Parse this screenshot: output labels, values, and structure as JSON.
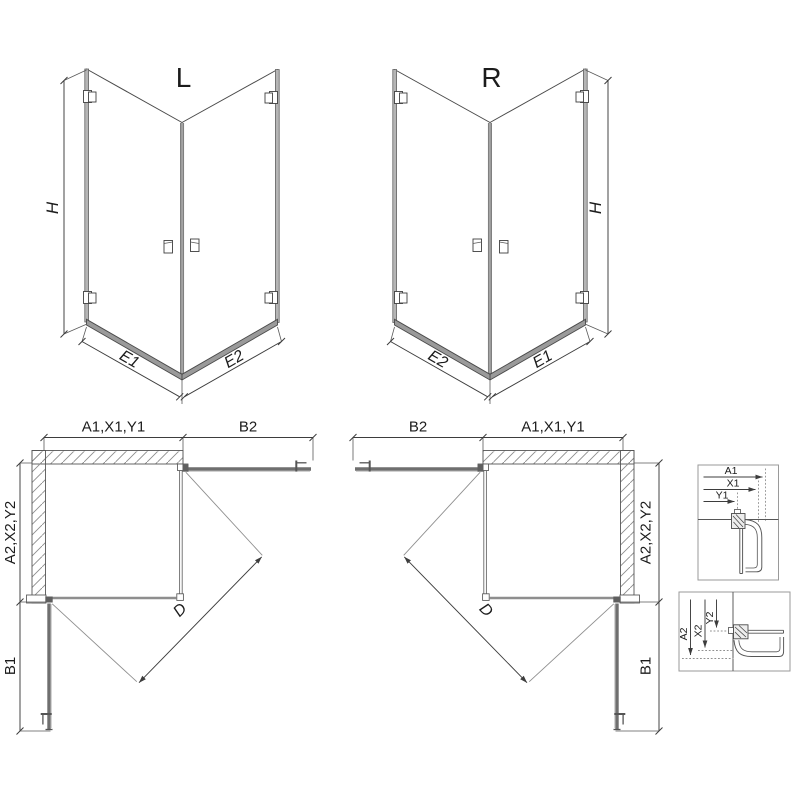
{
  "iso_left": {
    "label": "L",
    "dim_h": "H",
    "dim_left": "E1",
    "dim_right": "E2"
  },
  "iso_right": {
    "label": "R",
    "dim_h": "H",
    "dim_left": "E2",
    "dim_right": "E1"
  },
  "plan_left": {
    "dim_top_left": "A1,X1,Y1",
    "dim_top_right": "B2",
    "dim_side_top": "A2,X2,Y2",
    "dim_side_bottom": "B1",
    "dim_diag": "D"
  },
  "plan_right": {
    "dim_top_left": "B2",
    "dim_top_right": "A1,X1,Y1",
    "dim_side_top": "A2,X2,Y2",
    "dim_side_bottom": "B1",
    "dim_diag": "D"
  },
  "detail_top": {
    "dim_a": "A1",
    "dim_x": "X1",
    "dim_y": "Y1"
  },
  "detail_bottom": {
    "dim_a": "A2",
    "dim_x": "X2",
    "dim_y": "Y2"
  },
  "colors": {
    "line": "#434343",
    "rail": "#9a9a9a",
    "wall_band": "#b5b5b5",
    "hatch": "#8c8c8c",
    "door": "#6f6f6f",
    "text": "#1c1c1c",
    "background": "#ffffff"
  }
}
